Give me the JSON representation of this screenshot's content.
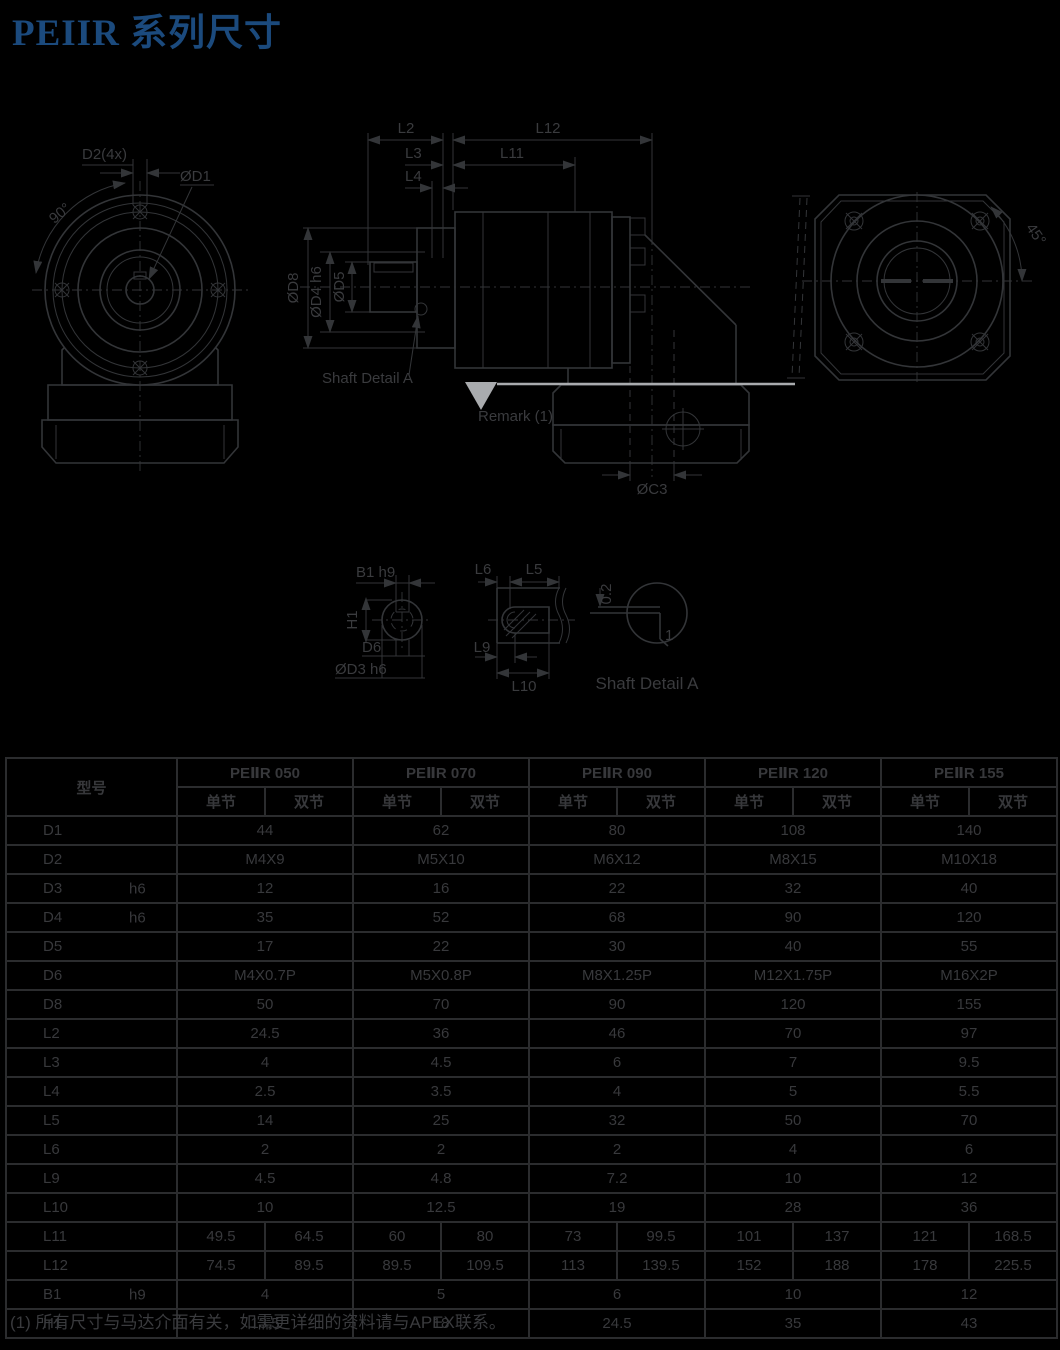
{
  "page_title": "PEIIR 系列尺寸",
  "drawings": {
    "front": {
      "d2_label": "D2(4x)",
      "d1_label": "ØD1",
      "angle_label": "90°"
    },
    "side": {
      "l2": "L2",
      "l12": "L12",
      "l3": "L3",
      "l11": "L11",
      "l4": "L4",
      "d8": "ØD8",
      "d4": "ØD4 h6",
      "d5": "ØD5",
      "c3": "ØC3",
      "shaft_detail_label": "Shaft Detail  A",
      "remark_label": "Remark (1)"
    },
    "rear": {
      "angle_label": "45°"
    },
    "details": {
      "b1": "B1 h9",
      "h1": "H1",
      "d6": "D6",
      "d3": "ØD3 h6",
      "l6": "L6",
      "l5": "L5",
      "l9": "L9",
      "l10": "L10",
      "offset": "0.2",
      "chamfer": "1",
      "caption": "Shaft  Detail  A"
    }
  },
  "table": {
    "model_header": "型号",
    "models": [
      "PEⅡR 050",
      "PEⅡR 070",
      "PEⅡR 090",
      "PEⅡR 120",
      "PEⅡR 155"
    ],
    "sub_headers": [
      "单节",
      "双节"
    ],
    "rows": [
      {
        "label": "D1",
        "tol": "",
        "type": "merged",
        "values": [
          "44",
          "62",
          "80",
          "108",
          "140"
        ]
      },
      {
        "label": "D2",
        "tol": "",
        "type": "merged",
        "values": [
          "M4X9",
          "M5X10",
          "M6X12",
          "M8X15",
          "M10X18"
        ]
      },
      {
        "label": "D3",
        "tol": "h6",
        "type": "merged",
        "values": [
          "12",
          "16",
          "22",
          "32",
          "40"
        ]
      },
      {
        "label": "D4",
        "tol": "h6",
        "type": "merged",
        "values": [
          "35",
          "52",
          "68",
          "90",
          "120"
        ]
      },
      {
        "label": "D5",
        "tol": "",
        "type": "merged",
        "values": [
          "17",
          "22",
          "30",
          "40",
          "55"
        ]
      },
      {
        "label": "D6",
        "tol": "",
        "type": "merged",
        "values": [
          "M4X0.7P",
          "M5X0.8P",
          "M8X1.25P",
          "M12X1.75P",
          "M16X2P"
        ]
      },
      {
        "label": "D8",
        "tol": "",
        "type": "merged",
        "values": [
          "50",
          "70",
          "90",
          "120",
          "155"
        ]
      },
      {
        "label": "L2",
        "tol": "",
        "type": "merged",
        "values": [
          "24.5",
          "36",
          "46",
          "70",
          "97"
        ]
      },
      {
        "label": "L3",
        "tol": "",
        "type": "merged",
        "values": [
          "4",
          "4.5",
          "6",
          "7",
          "9.5"
        ]
      },
      {
        "label": "L4",
        "tol": "",
        "type": "merged",
        "values": [
          "2.5",
          "3.5",
          "4",
          "5",
          "5.5"
        ]
      },
      {
        "label": "L5",
        "tol": "",
        "type": "merged",
        "values": [
          "14",
          "25",
          "32",
          "50",
          "70"
        ]
      },
      {
        "label": "L6",
        "tol": "",
        "type": "merged",
        "values": [
          "2",
          "2",
          "2",
          "4",
          "6"
        ]
      },
      {
        "label": "L9",
        "tol": "",
        "type": "merged",
        "values": [
          "4.5",
          "4.8",
          "7.2",
          "10",
          "12"
        ]
      },
      {
        "label": "L10",
        "tol": "",
        "type": "merged",
        "values": [
          "10",
          "12.5",
          "19",
          "28",
          "36"
        ]
      },
      {
        "label": "L11",
        "tol": "",
        "type": "split",
        "values": [
          [
            "49.5",
            "64.5"
          ],
          [
            "60",
            "80"
          ],
          [
            "73",
            "99.5"
          ],
          [
            "101",
            "137"
          ],
          [
            "121",
            "168.5"
          ]
        ]
      },
      {
        "label": "L12",
        "tol": "",
        "type": "split",
        "values": [
          [
            "74.5",
            "89.5"
          ],
          [
            "89.5",
            "109.5"
          ],
          [
            "113",
            "139.5"
          ],
          [
            "152",
            "188"
          ],
          [
            "178",
            "225.5"
          ]
        ]
      },
      {
        "label": "B1",
        "tol": "h9",
        "type": "merged",
        "values": [
          "4",
          "5",
          "6",
          "10",
          "12"
        ]
      },
      {
        "label": "H1",
        "tol": "",
        "type": "merged",
        "values": [
          "13.5",
          "18",
          "24.5",
          "35",
          "43"
        ]
      }
    ]
  },
  "footnote": "(1) 所有尺寸与马达介面有关，如需更详细的资料请与APEX联系。"
}
